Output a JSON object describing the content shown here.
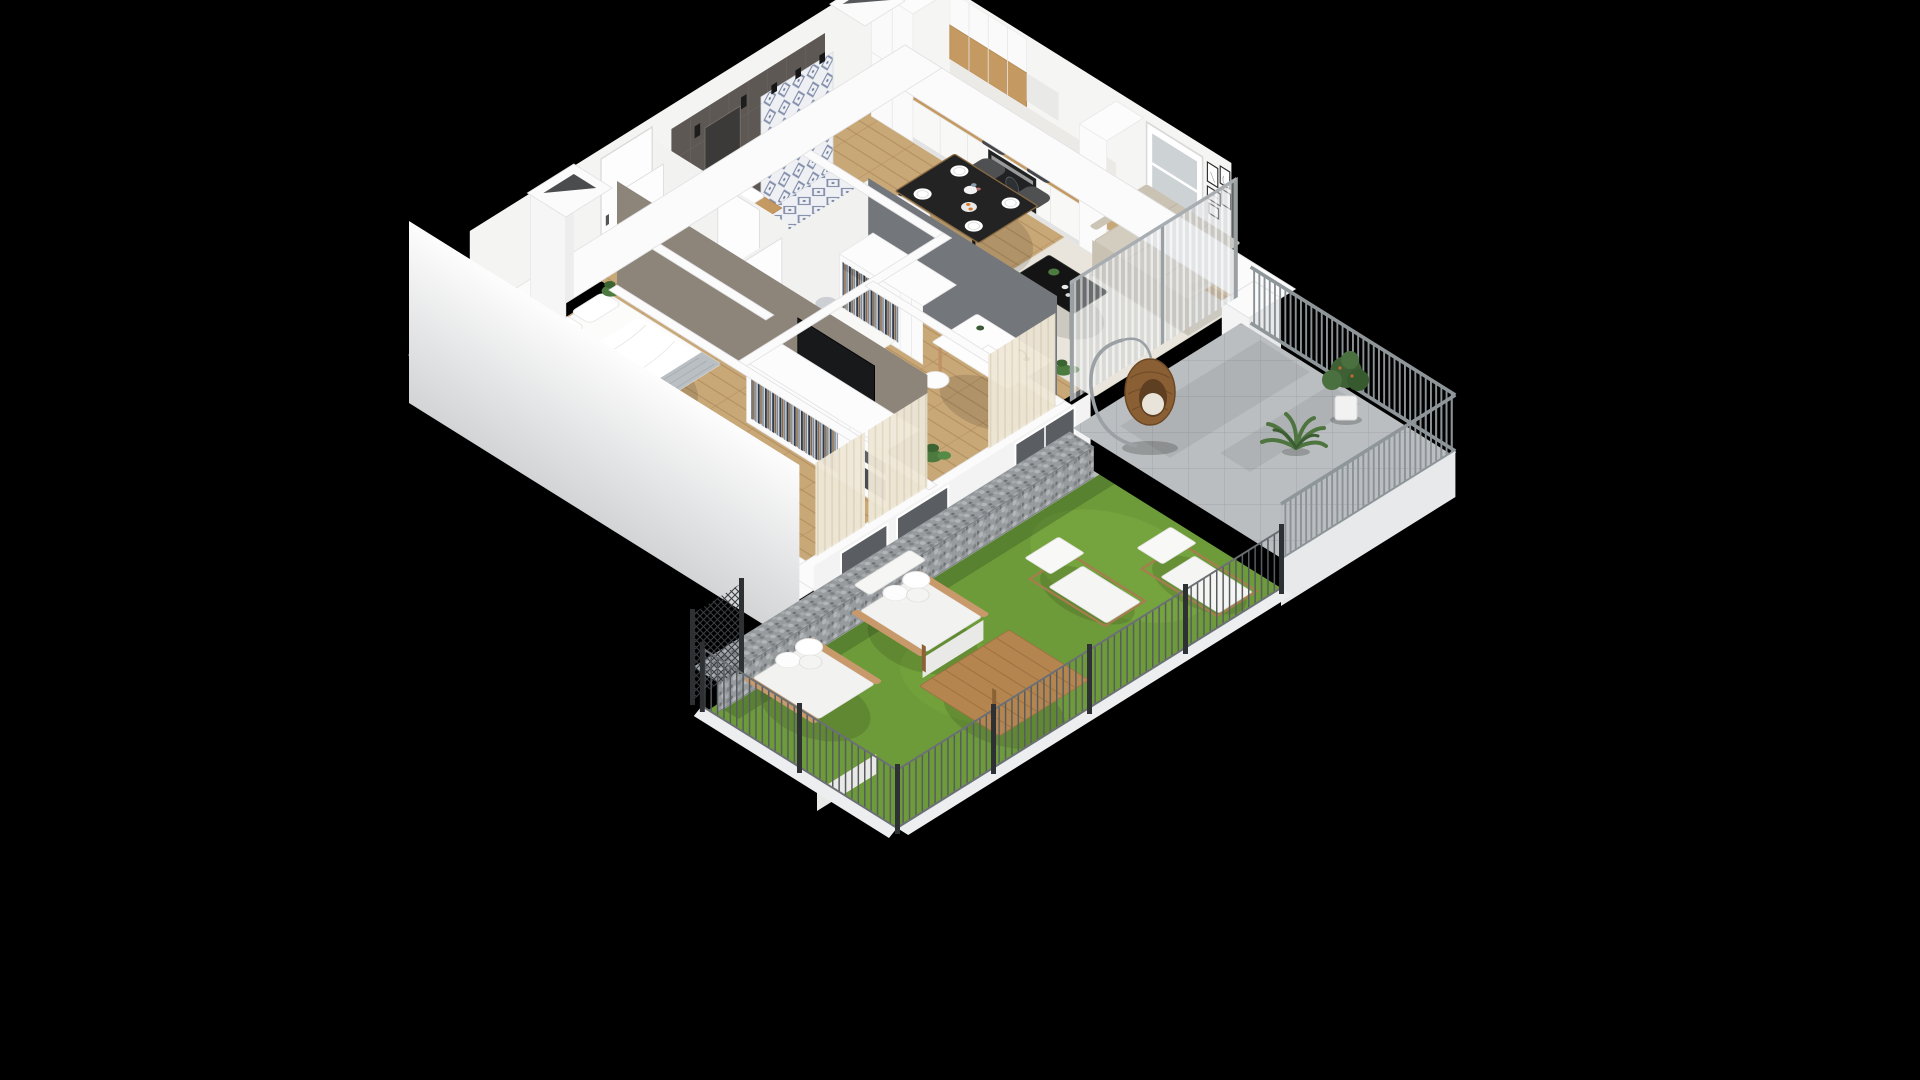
{
  "scene": {
    "background": "#000000",
    "view": "isometric-cutaway-apartment-render",
    "colors": {
      "wallTop": "#fbfbfb",
      "wallFace": "#f5f5f4",
      "wallOuterShade": "#d3d4d6",
      "woodFloor": "#c9a878",
      "plankLine": "#b28d5e",
      "rug": "#e9e5dc",
      "kitchenWood": "#c49a62",
      "applianceDark": "#17181a",
      "sofa": "#d3cdc0",
      "diningTable": "#232323",
      "chairDark": "#4e5052",
      "bathTileWall": "#5e5854",
      "bathFloorMotif": "#53628a",
      "taupeTvWall": "#8d847a",
      "accentWall": "#73767a",
      "terrace": "#babec0",
      "lawn": "#6e9b39",
      "lawnLight": "#7fae45",
      "gabion": "#979b9e",
      "railing": "#8b9296",
      "fencePost": "#2e3134",
      "eggChairRattan": "#8a5f34",
      "plantGreen": "#4c7a3f",
      "outdoorWood": "#b5854f",
      "curtainBeige": "#efe8d8",
      "white": "#ffffff"
    },
    "rooms": [
      {
        "name": "kitchen",
        "furniture": [
          "tall-cabinets",
          "kitchen-counter",
          "sink",
          "cooktop",
          "oven",
          "upper-cabinets"
        ]
      },
      {
        "name": "dining-area",
        "furniture": [
          "dining-table",
          "four-chairs",
          "plates",
          "vase",
          "fruit-bowl"
        ]
      },
      {
        "name": "living-room",
        "furniture": [
          "sofa",
          "coffee-table",
          "rug",
          "wall-art-frames",
          "window",
          "sheer-curtain",
          "plant"
        ]
      },
      {
        "name": "bathroom",
        "furniture": [
          "bathtub",
          "shower-curtain",
          "vanity-sink",
          "washing-machine",
          "mirror"
        ]
      },
      {
        "name": "hallway",
        "furniture": [
          "entry-door",
          "open-wardrobe",
          "ventilation-shaft"
        ]
      },
      {
        "name": "bedroom",
        "furniture": [
          "double-bed",
          "tv",
          "wardrobe-with-boxes",
          "side-rug",
          "curtained-windows"
        ]
      },
      {
        "name": "second-bedroom",
        "furniture": [
          "daybed",
          "desk",
          "chair",
          "desk-lamp",
          "wardrobe",
          "plant"
        ]
      },
      {
        "name": "terrace",
        "furniture": [
          "hanging-egg-chair",
          "potted-shrub",
          "palm-plant",
          "metal-railing",
          "paved-tiles"
        ]
      },
      {
        "name": "garden",
        "furniture": [
          "lawn",
          "sun-lounger",
          "sun-lounger",
          "garden-loveseat",
          "garden-loveseat",
          "wooden-coffee-table",
          "gabion-wall",
          "picket-fence",
          "gate"
        ]
      }
    ],
    "counts": {
      "wall_art_frames": 5,
      "dining_chairs": 4,
      "sun_loungers": 2,
      "garden_loveseats": 2,
      "terrace_plants": 2
    }
  }
}
